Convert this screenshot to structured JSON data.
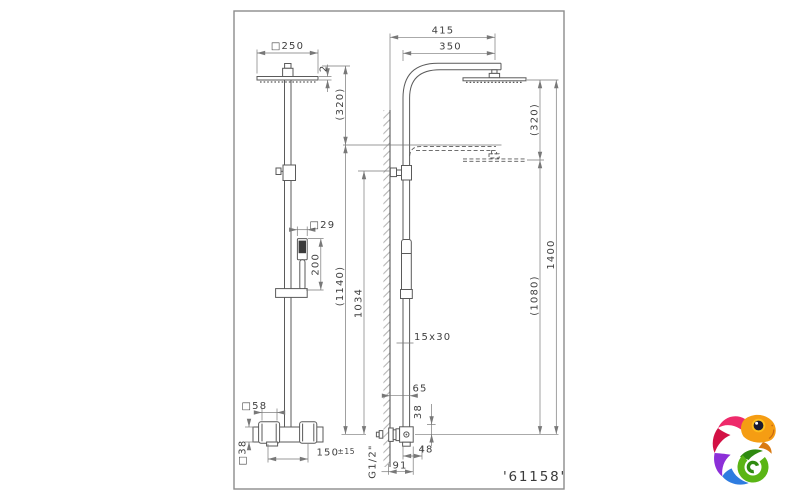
{
  "colors": {
    "background": "#ffffff",
    "frame": "#8c8c8c",
    "outline": "#5a5a5a",
    "dimension_lines": "#787878",
    "text": "#3f3f3f",
    "hatch": "#9a9a9a",
    "handshower_dark": "#3a3a3a"
  },
  "drawing": {
    "part_number": "'61158'",
    "front_view": {
      "head_width": "□250",
      "head_thickness": "2",
      "height_adjustment": "(320)",
      "handshower_width": "□29",
      "handshower_length": "200",
      "valve_escutcheon_size": "□58",
      "valve_body_size": "□38",
      "handle_spacing": "150",
      "handle_spacing_tolerance": "±15"
    },
    "side_view": {
      "arm_reach_to_head_center": "415",
      "arm_reach": "350",
      "head_height_adjustment": "(320)",
      "riser_height_max": "(1140)",
      "riser_height": "1034",
      "overall_height": "1400",
      "handshower_drop": "(1080)",
      "riser_profile": "15x30",
      "wall_clearance": "65",
      "outlet_drop": "38",
      "valve_depth": "48",
      "total_depth": "91",
      "connection_thread": "G1/2\""
    }
  },
  "logo": {
    "label": "chameleon",
    "colors": {
      "head": "#f59d13",
      "head_shadow": "#d97a12",
      "crest": "#ee2a6b",
      "body": "#d31145",
      "tail_purple": "#8c2fd8",
      "tail_blue": "#2e7ce0",
      "tail_green": "#5ab515",
      "tail_green_dark": "#2f8a11",
      "eye_ring": "#ffc01e",
      "eye": "#1b1b30"
    }
  }
}
